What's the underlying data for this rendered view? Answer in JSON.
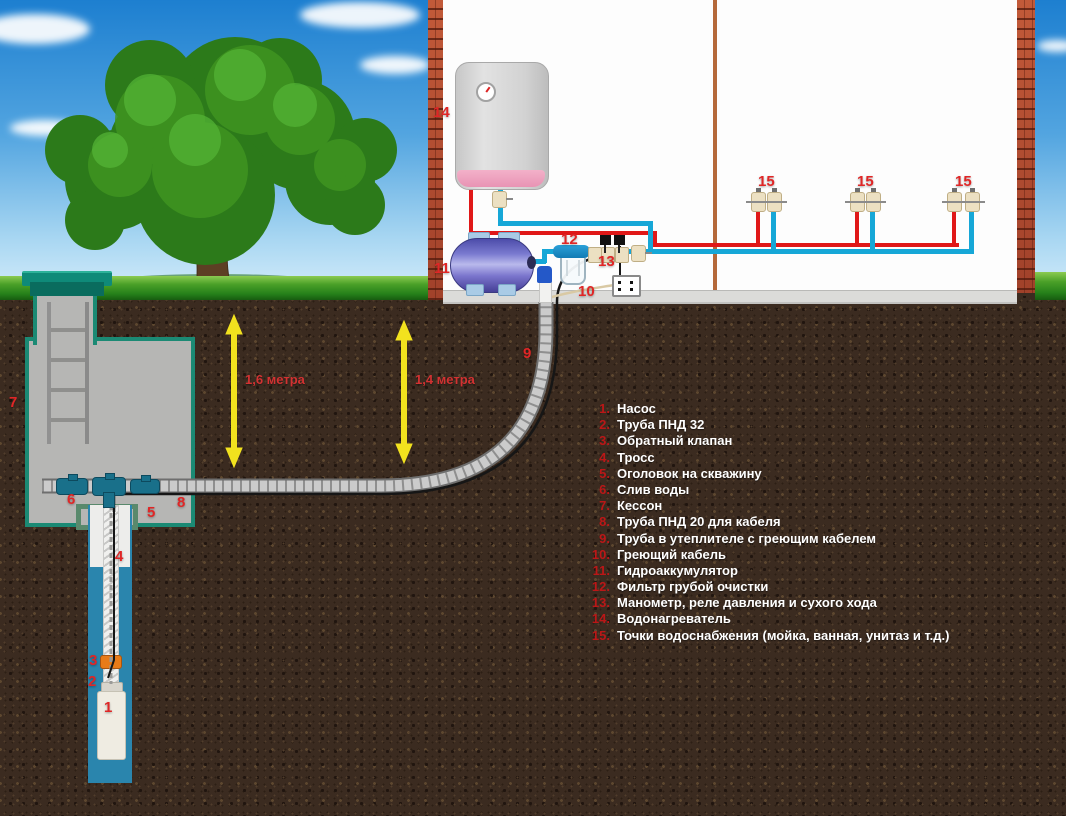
{
  "legend": {
    "items": [
      {
        "num": "1.",
        "text": "Насос"
      },
      {
        "num": "2.",
        "text": "Труба ПНД 32"
      },
      {
        "num": "3.",
        "text": "Обратный клапан"
      },
      {
        "num": "4.",
        "text": "Тросс"
      },
      {
        "num": "5.",
        "text": "Оголовок на скважину"
      },
      {
        "num": "6.",
        "text": "Слив воды"
      },
      {
        "num": "7.",
        "text": "Кессон"
      },
      {
        "num": "8.",
        "text": "Труба ПНД 20 для кабеля"
      },
      {
        "num": "9.",
        "text": "Труба в утеплителе с греющим кабелем"
      },
      {
        "num": "10.",
        "text": "Греющий кабель"
      },
      {
        "num": "11.",
        "text": "Гидроаккумулятор"
      },
      {
        "num": "12.",
        "text": "Фильтр грубой очистки"
      },
      {
        "num": "13.",
        "text": "Манометр, реле давления и сухого хода"
      },
      {
        "num": "14.",
        "text": "Водонагреватель"
      },
      {
        "num": "15.",
        "text": "Точки водоснабжения (мойка, ванная, унитаз и т.д.)"
      }
    ]
  },
  "markers": {
    "m1": "1",
    "m2": "2",
    "m3": "3",
    "m4": "4",
    "m5": "5",
    "m6": "6",
    "m7": "7",
    "m8": "8",
    "m9": "9",
    "m10": "10",
    "m11": "11",
    "m12": "12",
    "m13": "13",
    "m14": "14",
    "m15": "15"
  },
  "measures": {
    "left": "1,6 метра",
    "right": "1,4 метра"
  },
  "colors": {
    "pipe_hot": "#e01818",
    "pipe_cold": "#16a7d7",
    "marker_red": "#e02626",
    "legend_number": "#bb1717",
    "legend_text": "#ffffff",
    "arrow_yellow": "#f2e21e",
    "caisson_border": "#1b8a74",
    "soil_brown": "#3b2b20",
    "wall_divider": "#b5693a"
  }
}
